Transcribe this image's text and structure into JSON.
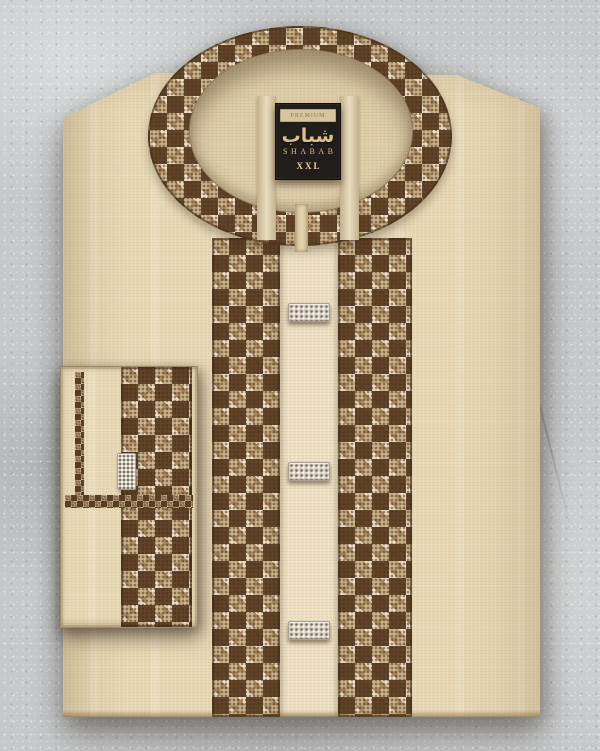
{
  "label": {
    "quality_line": "PREMIUM",
    "calligraphy": "شباب",
    "brand": "SHABAB",
    "size": "XXL"
  },
  "colors": {
    "marble_background": "#c6c8ca",
    "fabric_beige": "#e6d7b4",
    "embroidery_dark_brown": "#5b3f23",
    "embroidery_mid_brown": "#8a6848",
    "embroidery_cream": "#f0e5cd",
    "label_background": "#201d1a",
    "label_gold": "#d9bc8a",
    "label_band_cream": "#d7c59d",
    "button_fabric": "#d8d0c2"
  },
  "garment": {
    "placket_buttons_count": "3"
  }
}
